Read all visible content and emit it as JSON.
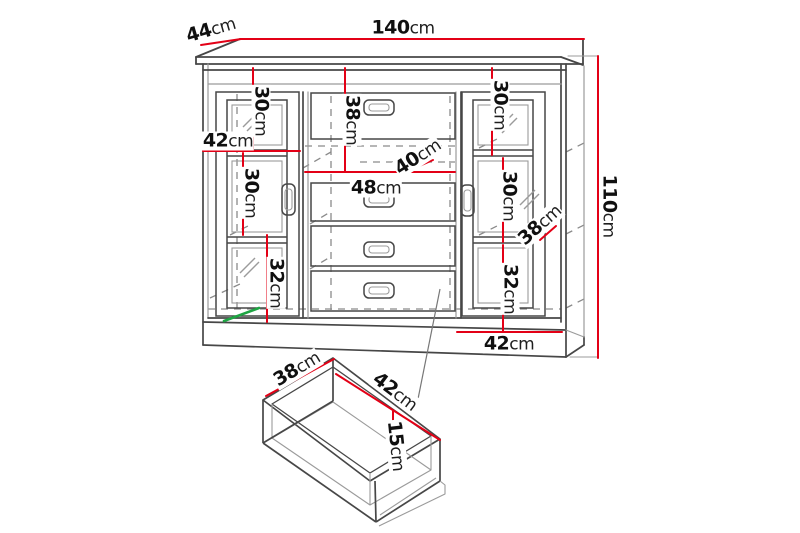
{
  "diagram": {
    "kind": "furniture-dimension-drawing",
    "unit": "cm",
    "colors": {
      "dimension_line": "#e30016",
      "outline": "#474747",
      "outline_light": "#9b9b9b",
      "hidden_edge": "#8a8a8a",
      "accent_green": "#1ea543",
      "background": "#ffffff",
      "text": "#101010"
    }
  },
  "cabinet": {
    "overall_width": {
      "value": "140",
      "unit": "cm"
    },
    "overall_depth": {
      "value": "44",
      "unit": "cm"
    },
    "overall_height": {
      "value": "110",
      "unit": "cm"
    },
    "left_section": {
      "top_shelf_height": {
        "value": "30",
        "unit": "cm"
      },
      "section_width": {
        "value": "42",
        "unit": "cm"
      },
      "middle_shelf_height": {
        "value": "30",
        "unit": "cm"
      },
      "bottom_shelf_height": {
        "value": "32",
        "unit": "cm"
      }
    },
    "middle_section": {
      "top_compartment_height": {
        "value": "38",
        "unit": "cm"
      },
      "compartment_depth": {
        "value": "40",
        "unit": "cm"
      },
      "drawer_width": {
        "value": "48",
        "unit": "cm"
      }
    },
    "right_section": {
      "top_shelf_height": {
        "value": "30",
        "unit": "cm"
      },
      "middle_shelf_height": {
        "value": "30",
        "unit": "cm"
      },
      "shelf_depth": {
        "value": "38",
        "unit": "cm"
      },
      "bottom_shelf_height": {
        "value": "32",
        "unit": "cm"
      },
      "section_width": {
        "value": "42",
        "unit": "cm"
      }
    }
  },
  "drawer_detail": {
    "width": {
      "value": "38",
      "unit": "cm"
    },
    "length": {
      "value": "42",
      "unit": "cm"
    },
    "depth": {
      "value": "15",
      "unit": "cm"
    }
  }
}
